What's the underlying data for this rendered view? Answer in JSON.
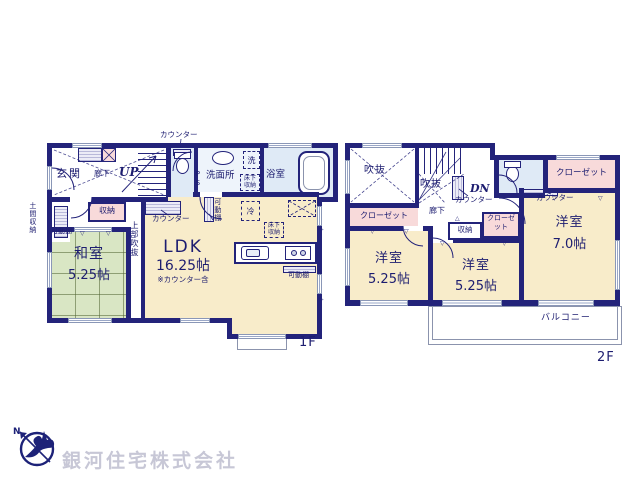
{
  "floor1": {
    "label": "1F",
    "entrance": "玄関",
    "hallway": "廊下",
    "stairs_up": "UP",
    "counter_top": "カウンター",
    "pipe_space": "PS",
    "washroom": "洗面所",
    "washer": "洗",
    "underfloor_storage": "床下収納",
    "bathroom": "浴室",
    "doma_storage": "土間収納",
    "movable_shelf_left": "可動棚",
    "storage": "収納",
    "counter_mid": "カウンター",
    "upper_void": "上部吹抜",
    "japanese_room": {
      "name": "和室",
      "size": "5.25帖"
    },
    "ldk": {
      "name": "LDK",
      "size": "16.25帖",
      "note": "※カウンター含"
    },
    "fridge": "冷",
    "underfloor_storage2": "床下収納",
    "movable_shelf_pantry": "可動棚",
    "movable_shelf_right": "可動棚"
  },
  "floor2": {
    "label": "2F",
    "void1": "吹抜",
    "void2": "吹抜",
    "stairs_down": "DN",
    "counter1": "カウンター",
    "counter2": "カウンター",
    "hallway": "廊下",
    "closet_left": "クローゼット",
    "closet_mid": "クローゼット",
    "closet_right": "クローゼット",
    "storage": "収納",
    "rooms": [
      {
        "name": "洋室",
        "size": "5.25帖"
      },
      {
        "name": "洋室",
        "size": "5.25帖"
      },
      {
        "name": "洋室",
        "size": "7.0帖"
      }
    ],
    "balcony": "バルコニー"
  },
  "company": {
    "name": "銀河住宅株式会社",
    "compass_n": "N"
  },
  "colors": {
    "wall": "#23237a",
    "room_cream": "#f8ecca",
    "tatami_green": "#d9e6c4",
    "closet_pink": "#f8dada",
    "wet_blue": "#dfeaf6",
    "logo_text": "#c7c7d6"
  }
}
